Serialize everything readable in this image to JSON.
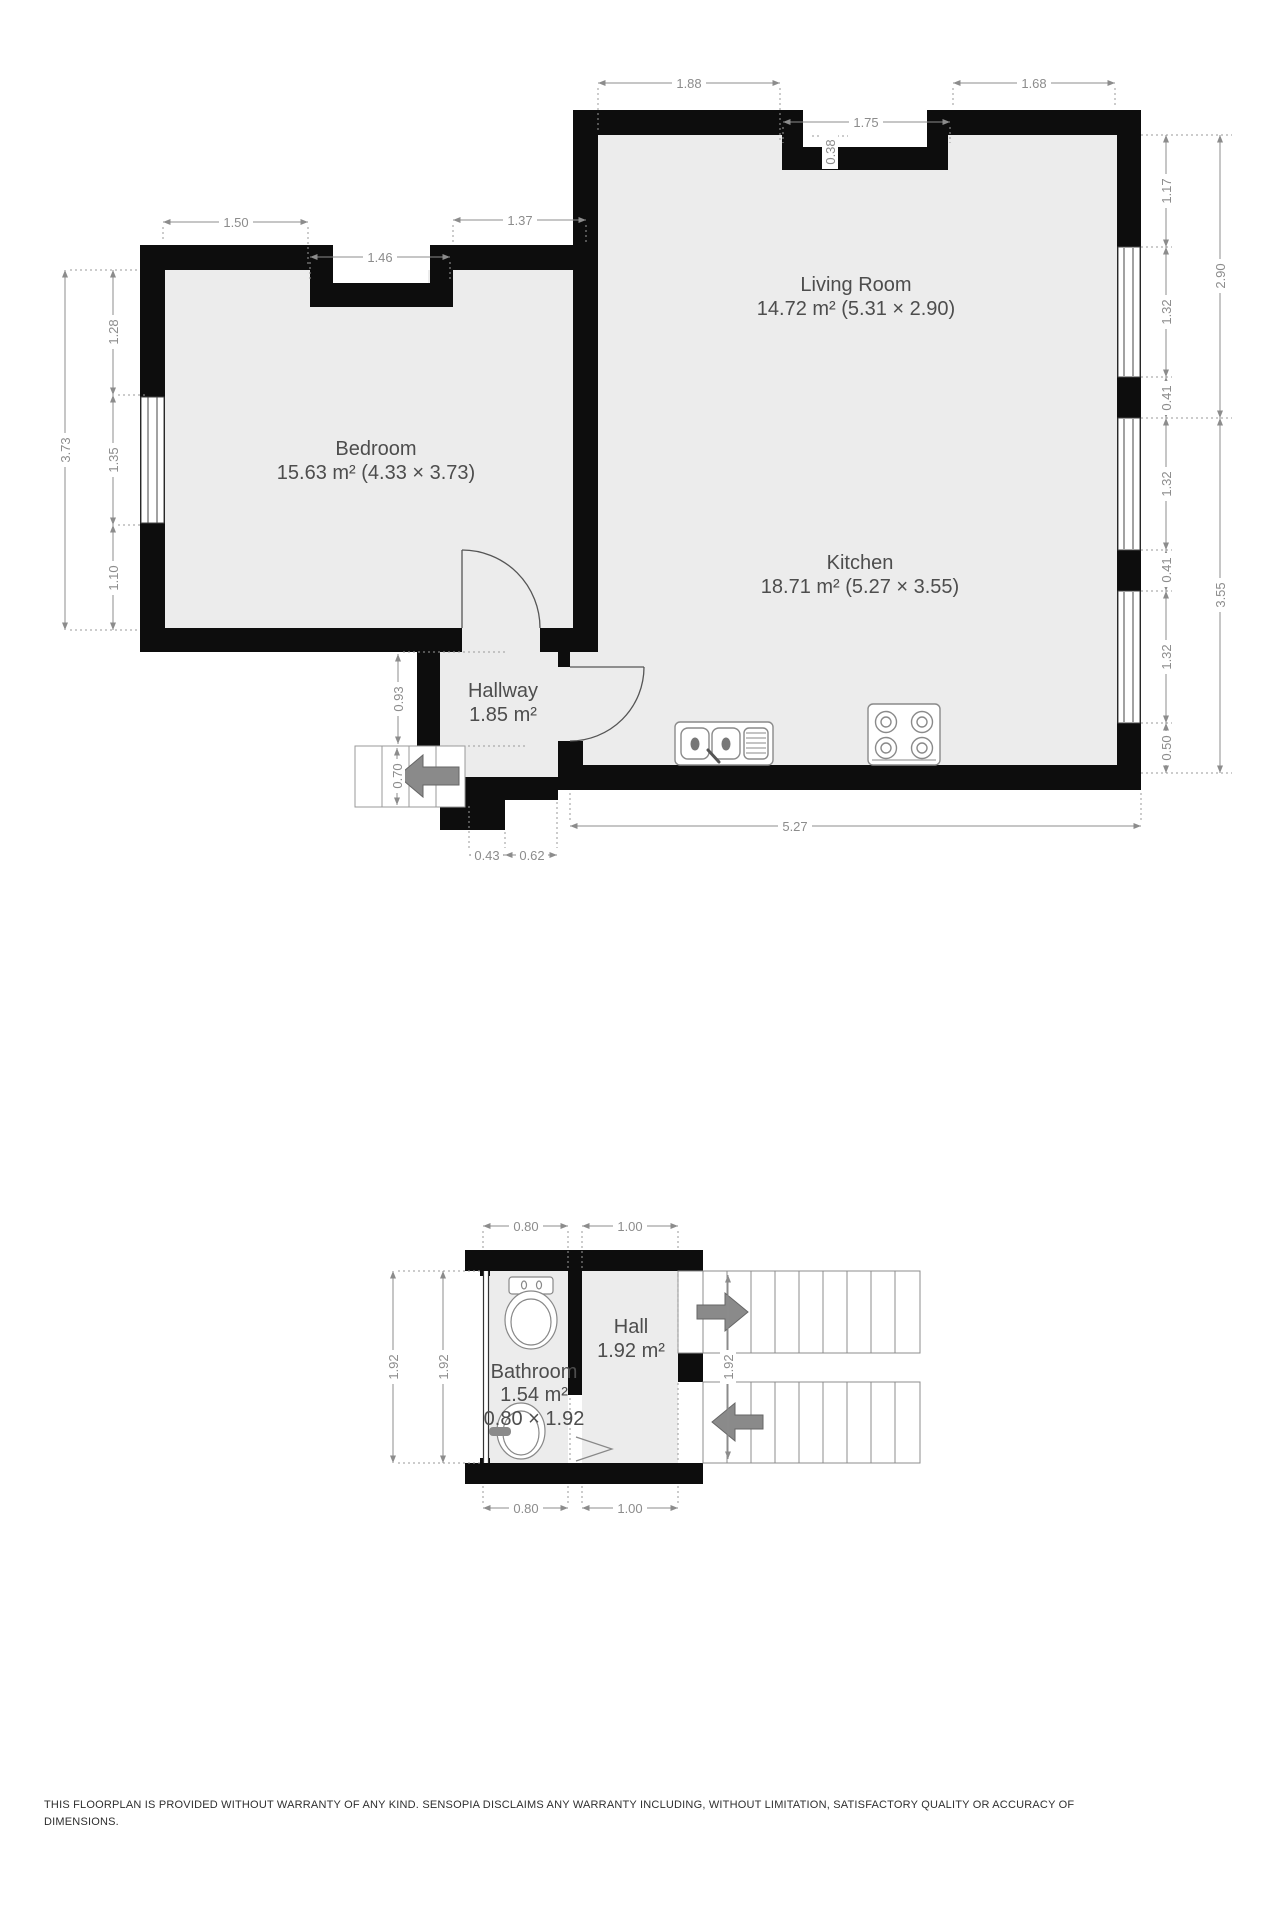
{
  "rooms": {
    "living": {
      "name": "Living Room",
      "area": "14.72 m² (5.31 × 2.90)"
    },
    "kitchen": {
      "name": "Kitchen",
      "area": "18.71 m² (5.27 × 3.55)"
    },
    "bedroom": {
      "name": "Bedroom",
      "area": "15.63 m² (4.33 × 3.73)"
    },
    "hallway": {
      "name": "Hallway",
      "area": "1.85 m²"
    },
    "bathroom": {
      "name": "Bathroom",
      "area": "1.54 m²",
      "size": "0.80 × 1.92"
    },
    "hall": {
      "name": "Hall",
      "area": "1.92 m²"
    }
  },
  "dims_main": {
    "top_1": "1.88",
    "top_2": "1.68",
    "notch_w": "1.75",
    "notch_d": "0.38",
    "bed_top_1": "1.50",
    "bed_notch": "1.46",
    "bed_top_2": "1.37",
    "left_total": "3.73",
    "left_1": "1.28",
    "left_2": "1.35",
    "left_3": "1.10",
    "right_1": "1.17",
    "right_2": "1.32",
    "right_3": "0.41",
    "right_4": "1.32",
    "right_5": "0.41",
    "right_6": "1.32",
    "right_7": "0.50",
    "right_living": "2.90",
    "right_kitchen": "3.55",
    "bottom_kitchen": "5.27",
    "bottom_1": "0.43",
    "bottom_2": "0.62",
    "hall_side": "0.93",
    "steps_side": "0.70"
  },
  "dims_lower": {
    "top_bath": "0.80",
    "top_hall": "1.00",
    "left_a": "1.92",
    "left_b": "1.92",
    "stairs": "1.92",
    "bottom_bath": "0.80",
    "bottom_hall": "1.00"
  },
  "footer": {
    "line1": "THIS FLOORPLAN IS PROVIDED WITHOUT WARRANTY OF ANY KIND. SENSOPIA DISCLAIMS ANY WARRANTY INCLUDING, WITHOUT LIMITATION, SATISFACTORY QUALITY OR ACCURACY OF",
    "line2": "DIMENSIONS."
  },
  "colors": {
    "wall": "#0d0d0d",
    "floor": "#ececec",
    "dimension": "#8c8c8c",
    "arrow": "#8a8a8a",
    "label": "#4d4d4d"
  }
}
